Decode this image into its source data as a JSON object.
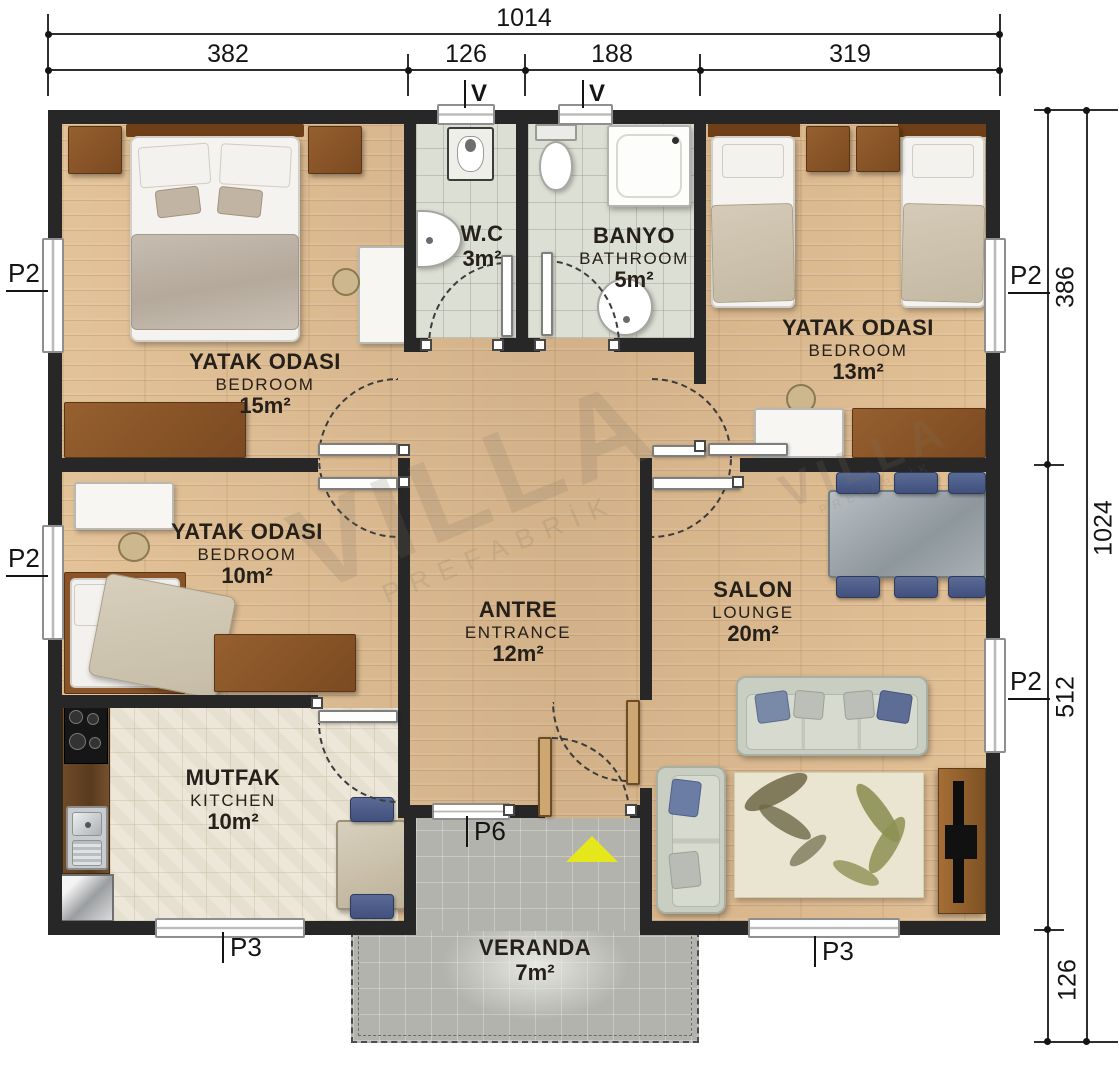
{
  "dims": {
    "top_total": "1014",
    "top_segments": [
      "382",
      "126",
      "188",
      "319"
    ],
    "right_total": "1024",
    "right_segments": [
      "386",
      "512",
      "126"
    ]
  },
  "tags": {
    "p2": "P2",
    "p3": "P3",
    "p6": "P6",
    "v": "V"
  },
  "rooms": {
    "bedroom15": {
      "tr": "YATAK ODASI",
      "en": "BEDROOM",
      "area": "15m²"
    },
    "wc": {
      "tr": "W.C",
      "area": "3m²"
    },
    "banyo": {
      "tr": "BANYO",
      "en": "BATHROOM",
      "area": "5m²"
    },
    "bedroom13": {
      "tr": "YATAK ODASI",
      "en": "BEDROOM",
      "area": "13m²"
    },
    "bedroom10": {
      "tr": "YATAK ODASI",
      "en": "BEDROOM",
      "area": "10m²"
    },
    "antre": {
      "tr": "ANTRE",
      "en": "ENTRANCE",
      "area": "12m²"
    },
    "salon": {
      "tr": "SALON",
      "en": "LOUNGE",
      "area": "20m²"
    },
    "mutfak": {
      "tr": "MUTFAK",
      "en": "KITCHEN",
      "area": "10m²"
    },
    "veranda": {
      "tr": "VERANDA",
      "area": "7m²"
    }
  },
  "watermark": {
    "big": "VILLA",
    "small": "PREFABRİK"
  },
  "colors": {
    "wall": "#272727",
    "wood": "#deba8e",
    "bath_tile": "#dcdfd4",
    "kitchen_tile": "#eae4d4",
    "veranda": "#b2b3ad",
    "arrow": "#e5e71c"
  }
}
